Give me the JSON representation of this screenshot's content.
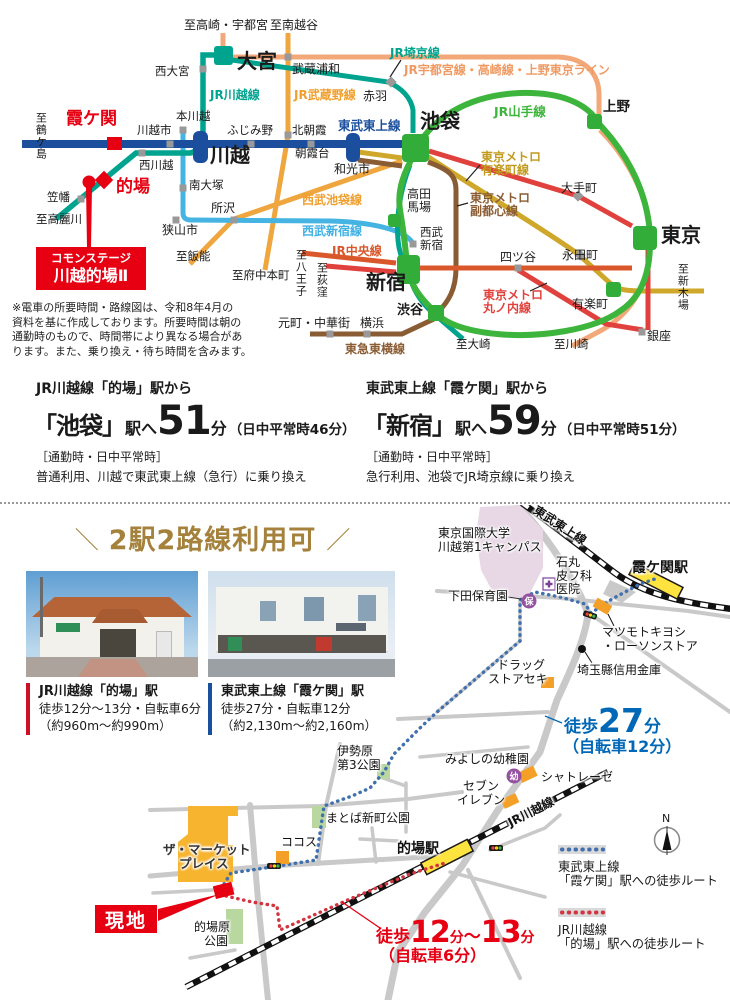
{
  "colors": {
    "accent_red": "#e60012",
    "tobu_blue": "#1b4f9e",
    "jr_teal": "#00a48e",
    "yamanote_green": "#3db53c",
    "musashino_orange": "#f0a63e",
    "utsunomiya_peach": "#f2a878",
    "yurakucho_gold": "#cfa72a",
    "fukutoshin_brown": "#8a5c33",
    "marunouchi_red": "#e0413c",
    "chuo_vermillion": "#d9572b",
    "seibu_lightblue": "#45b4e2",
    "heading_gold": "#a5823c",
    "walk_blue": "#0068b7",
    "station_yellow": "#ffe33f"
  },
  "rail_map": {
    "line_labels": {
      "jr_kawagoe": "JR川越線",
      "jr_musashino": "JR武蔵野線",
      "jr_saikyo": "JR埼京線",
      "jr_utsunomiya": "JR宇都宮線・高崎線・上野東京ライン",
      "jr_yamanote": "JR山手線",
      "tobu_tojo": "東武東上線",
      "metro_yurakucho_1": "東京メトロ",
      "metro_yurakucho_2": "有楽町線",
      "metro_fukutoshin_1": "東京メトロ",
      "metro_fukutoshin_2": "副都心線",
      "metro_marunouchi_1": "東京メトロ",
      "metro_marunouchi_2": "丸ノ内線",
      "seibu_ikebukuro": "西武池袋線",
      "seibu_shinjuku": "西武新宿線",
      "jr_chuo": "JR中央線",
      "tokyu_toyoko": "東急東横線"
    },
    "stations": {
      "omiya": "大宮",
      "nishi_omiya": "西大宮",
      "musashi_urawa": "武蔵浦和",
      "akabane": "赤羽",
      "kasumigaseki": "霞ケ関",
      "kawagoeshi": "川越市",
      "hon_kawagoe": "本川越",
      "kawagoe": "川越",
      "nishi_kawagoe": "西川越",
      "fujimino": "ふじみ野",
      "kita_asaka": "北朝霞",
      "asakadai": "朝霞台",
      "wakoshi": "和光市",
      "ikebukuro": "池袋",
      "minami_otsuka": "南大塚",
      "matoba": "的場",
      "kasahata": "笠幡",
      "tokorozawa": "所沢",
      "sayamashi": "狭山市",
      "takadanobaba_1": "高田",
      "takadanobaba_2": "馬場",
      "seibu_shinjuku_1": "西武",
      "seibu_shinjuku_2": "新宿",
      "ueno": "上野",
      "otemachi": "大手町",
      "tokyo": "東京",
      "yotsuya": "四ツ谷",
      "nagatacho": "永田町",
      "shinjuku": "新宿",
      "yurakucho": "有楽町",
      "shibuya": "渋谷",
      "ginza": "銀座",
      "yokohama": "横浜",
      "motomachi": "元町・中華街"
    },
    "destinations": {
      "takasaki": "至高崎・宇都宮",
      "minami_koshigaya": "至南越谷",
      "tsurugashima": "至鶴ケ島",
      "komagawa": "至高麗川",
      "hanno": "至飯能",
      "fuchu": "至府中本町",
      "hachioji": "至八王子",
      "ogikubo": "至荻窪",
      "shin_kiba": "至新木場",
      "osaki": "至大崎",
      "kawasaki": "至川崎"
    },
    "callout": {
      "line1": "コモンステージ",
      "line2": "川越的場Ⅱ"
    },
    "note": [
      "※電車の所要時間・路線図は、令和8年4月の",
      "資料を基に作成しております。所要時間は朝の",
      "通勤時のもので、時間帯により異なる場合があ",
      "ります。また、乗り換え・待ち時間を含みます。"
    ]
  },
  "access": {
    "left": {
      "from": "JR川越線「的場」駅から",
      "dest": "「池袋」",
      "eki": "駅へ",
      "min": "51",
      "unit": "分",
      "paren": "（日中平常時46分）",
      "cond": "［通勤時・日中平常時］",
      "detail": "普通利用、川越で東武東上線（急行）に乗り換え"
    },
    "right": {
      "from": "東武東上線「霞ケ関」駅から",
      "dest": "「新宿」",
      "eki": "駅へ",
      "min": "59",
      "unit": "分",
      "paren": "（日中平常時51分）",
      "cond": "［通勤時・日中平常時］",
      "detail": "急行利用、池袋でJR埼京線に乗り換え"
    }
  },
  "bottom": {
    "heading": {
      "slash_l": "＼",
      "text": "2駅2路線利用可",
      "slash_r": "／"
    },
    "captions": {
      "matoba": {
        "title": "JR川越線「的場」駅",
        "line1": "徒歩12分〜13分・自転車6分",
        "line2": "（約960m〜約990m）"
      },
      "kasumigaseki": {
        "title": "東武東上線「霞ケ関」駅",
        "line1": "徒歩27分・自転車12分",
        "line2": "（約2,130m〜約2,160m）"
      }
    },
    "map": {
      "tobu_line": "東武東上線",
      "jr_line": "JR川越線",
      "kasumigaseki_sta": "霞ケ関駅",
      "matoba_sta": "的場駅",
      "univ1": "東京国際大学",
      "univ2": "川越第1キャンパス",
      "ishimaru1": "石丸",
      "ishimaru2": "皮フ科",
      "ishimaru3": "医院",
      "shimoda": "下田保育園",
      "hoiku_icon": "保",
      "matsumoto1": "マツモトキヨシ",
      "matsumoto2": "・ローソンストア",
      "shinkin": "埼玉縣信用金庫",
      "drug1": "ドラッグ",
      "drug2": "ストアセキ",
      "walk27": {
        "w": "徒歩",
        "n": "27",
        "u": "分",
        "bike": "（自転車12分）"
      },
      "miyoshino": "みよしの幼稚園",
      "yochien_icon": "幼",
      "chateraise": "シャトレーゼ",
      "seven1": "セブン",
      "seven2": "イレブン",
      "isehara1": "伊勢原",
      "isehara2": "第3公園",
      "shinmachi_park": "まとば新町公園",
      "cocos": "ココス",
      "market1": "ザ・マーケット",
      "market2": "プレイス",
      "genchi": "現地",
      "matobahara1": "的場原",
      "matobahara2": "公園",
      "walk1213": {
        "w": "徒歩",
        "n1": "12",
        "u1": "分",
        "tilde": "〜",
        "n2": "13",
        "u2": "分",
        "bike": "（自転車6分）"
      },
      "legend": {
        "blue1": "東武東上線",
        "blue2": "「霞ケ関」駅への徒歩ルート",
        "red1": "JR川越線",
        "red2": "「的場」駅への徒歩ルート"
      },
      "compass": "N"
    }
  }
}
